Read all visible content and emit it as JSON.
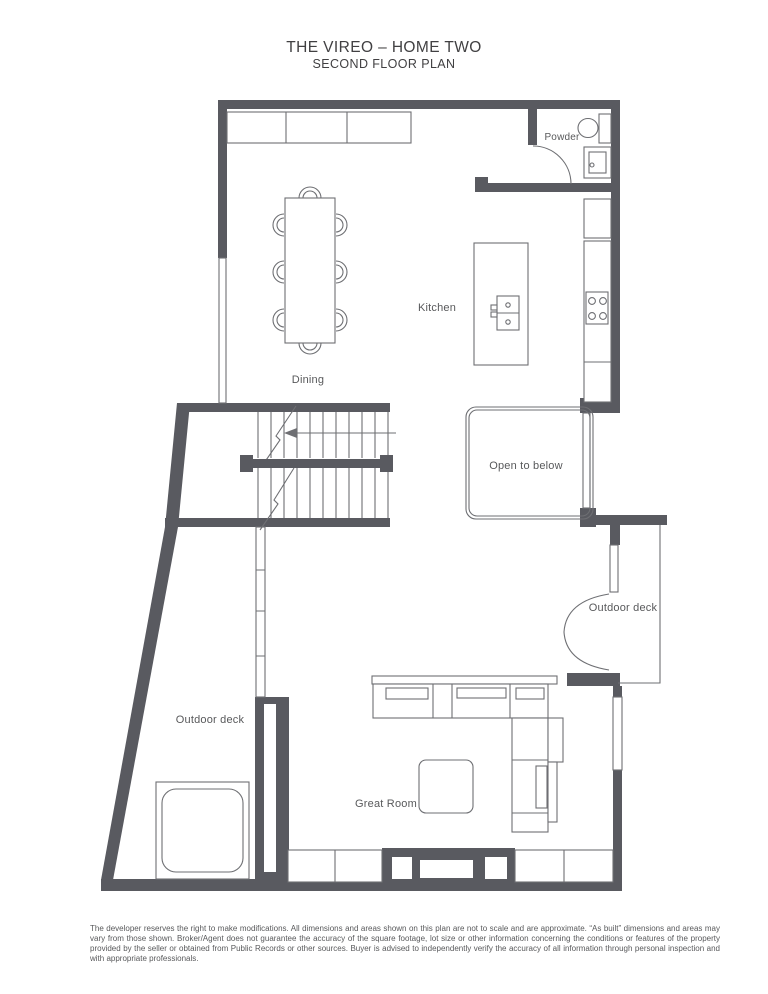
{
  "title": {
    "line1": "THE VIREO – HOME TWO",
    "line2": "SECOND FLOOR PLAN"
  },
  "labels": {
    "powder": "Powder",
    "kitchen": "Kitchen",
    "dining": "Dining",
    "open_to_below": "Open to below",
    "outdoor_deck_right": "Outdoor deck",
    "outdoor_deck_left": "Outdoor deck",
    "great_room": "Great Room"
  },
  "disclaimer": "The developer reserves the right to make modifications. All dimensions and areas shown on this plan are not to scale and are approximate. “As built” dimensions and areas may vary from those shown. Broker/Agent does not guarantee the accuracy of the square footage, lot size or other information concerning the conditions or features of the property provided by the seller or obtained from Public Records or other sources. Buyer is advised to independently verify the accuracy of all information through personal inspection and with appropriate professionals.",
  "colors": {
    "wall": "#595a60",
    "line": "#6e6f73",
    "label": "#58595b",
    "title": "#414042",
    "background": "#ffffff"
  }
}
